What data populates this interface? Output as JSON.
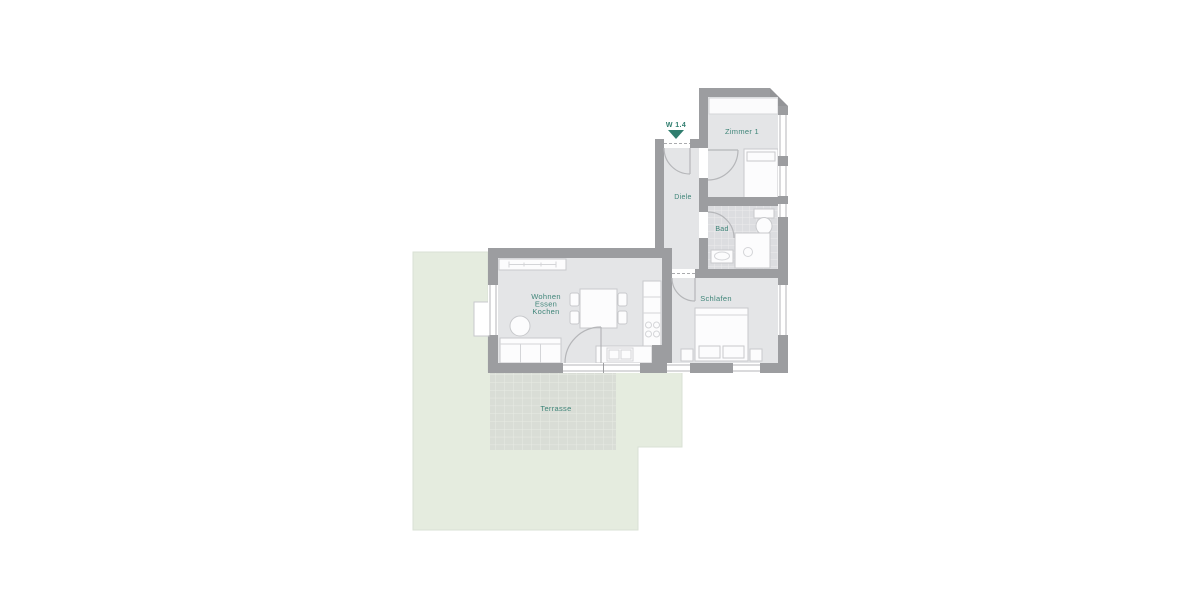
{
  "marker": {
    "label": "W 1.4"
  },
  "rooms": {
    "zimmer1": {
      "label": "Zimmer 1"
    },
    "diele": {
      "label": "Diele"
    },
    "bad": {
      "label": "Bad"
    },
    "schlafen": {
      "label": "Schlafen"
    },
    "living": {
      "line1": "Wohnen",
      "line2": "Essen",
      "line3": "Kochen"
    },
    "terrasse": {
      "label": "Terrasse"
    }
  },
  "colors": {
    "garden": "#e5ecdf",
    "garden_edge": "#d9e1d4",
    "terrace_tile": "#d9ddd6",
    "floor": "#e4e5e7",
    "wall": "#9c9da0",
    "label_teal": "#3f8579",
    "marker_teal": "#2f7d6e"
  }
}
